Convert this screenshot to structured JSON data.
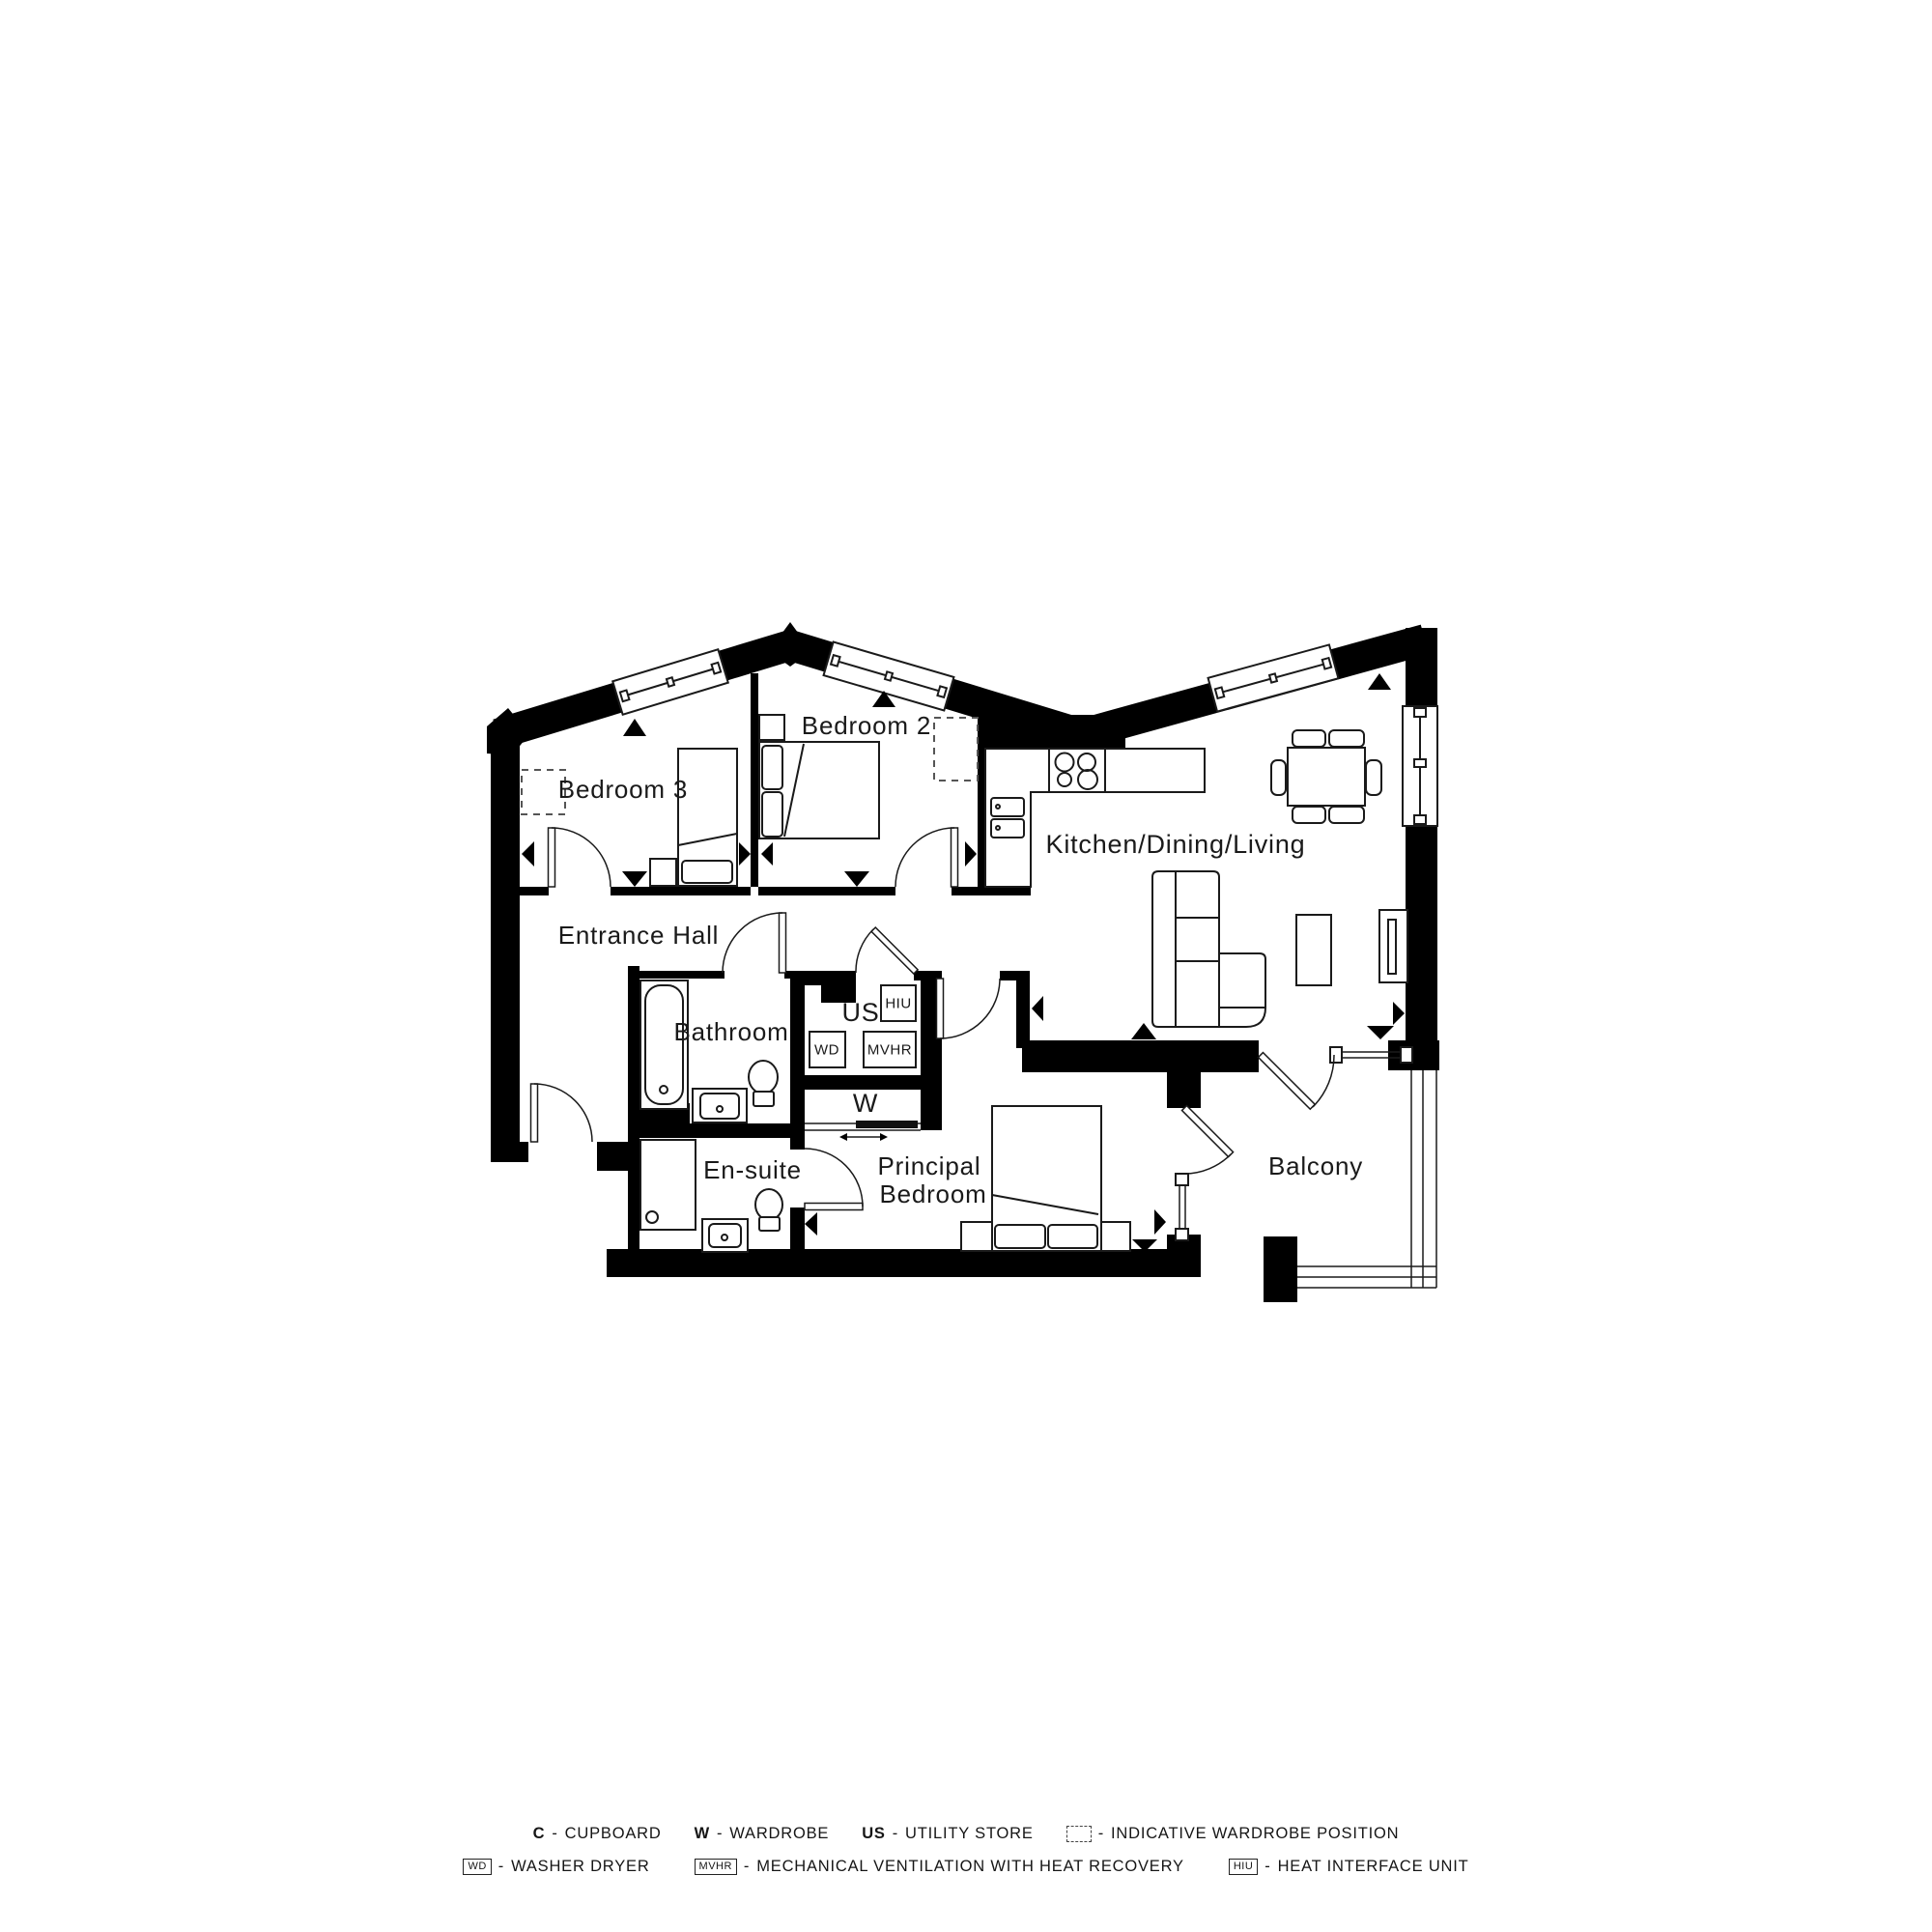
{
  "plan": {
    "rooms": {
      "bedroom3": "Bedroom 3",
      "bedroom2": "Bedroom 2",
      "kitchen_dining_living": "Kitchen/Dining/Living",
      "entrance_hall": "Entrance Hall",
      "bathroom": "Bathroom",
      "utility_store": "US",
      "wardrobe": "W",
      "ensuite": "En-suite",
      "principal_bedroom_line1": "Principal",
      "principal_bedroom_line2": "Bedroom",
      "balcony": "Balcony"
    },
    "equipment": {
      "hiu": "HIU",
      "wd": "WD",
      "mvhr": "MVHR"
    }
  },
  "legend": {
    "separator": "-",
    "row1": [
      {
        "code": "C",
        "label": "CUPBOARD"
      },
      {
        "code": "W",
        "label": "WARDROBE"
      },
      {
        "code": "US",
        "label": "UTILITY STORE"
      },
      {
        "code": "",
        "label": "INDICATIVE WARDROBE POSITION"
      }
    ],
    "row2": [
      {
        "code": "WD",
        "label": "WASHER DRYER"
      },
      {
        "code": "MVHR",
        "label": "MECHANICAL VENTILATION WITH HEAT RECOVERY"
      },
      {
        "code": "HIU",
        "label": "HEAT INTERFACE UNIT"
      }
    ]
  },
  "colors": {
    "wall": "#000000",
    "line": "#1a1a1a",
    "background": "#ffffff"
  }
}
